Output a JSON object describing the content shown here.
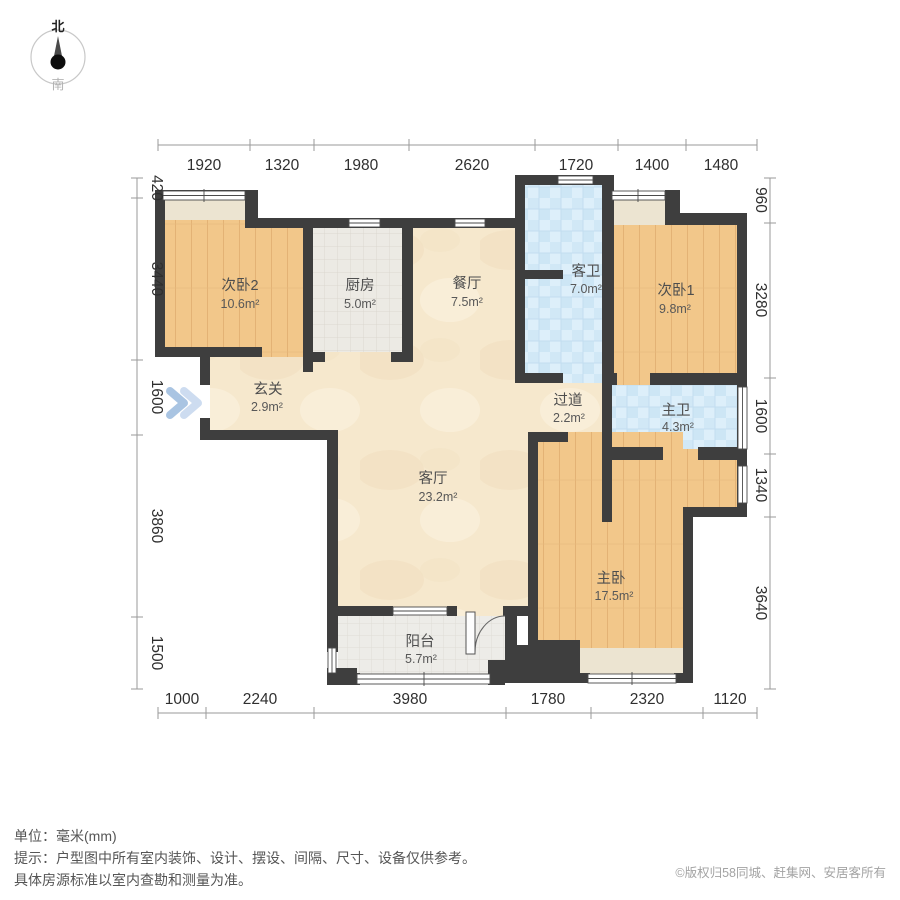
{
  "compass": {
    "north": "北",
    "south": "南"
  },
  "rooms": [
    {
      "id": "bedroom2",
      "name": "次卧2",
      "area": "10.6m²"
    },
    {
      "id": "kitchen",
      "name": "厨房",
      "area": "5.0m²"
    },
    {
      "id": "dining",
      "name": "餐厅",
      "area": "7.5m²"
    },
    {
      "id": "guest-bath",
      "name": "客卫",
      "area": "7.0m²"
    },
    {
      "id": "bedroom1",
      "name": "次卧1",
      "area": "9.8m²"
    },
    {
      "id": "entry",
      "name": "玄关",
      "area": "2.9m²"
    },
    {
      "id": "hallway",
      "name": "过道",
      "area": "2.2m²"
    },
    {
      "id": "master-bath",
      "name": "主卫",
      "area": "4.3m²"
    },
    {
      "id": "living",
      "name": "客厅",
      "area": "23.2m²"
    },
    {
      "id": "master-bedroom",
      "name": "主卧",
      "area": "17.5m²"
    },
    {
      "id": "balcony",
      "name": "阳台",
      "area": "5.7m²"
    }
  ],
  "dimensions": {
    "top": [
      "1920",
      "1320",
      "1980",
      "2620",
      "1720",
      "1400",
      "1480"
    ],
    "bottom": [
      "1000",
      "2240",
      "3980",
      "1780",
      "2320",
      "1120"
    ],
    "left": [
      "420",
      "3440",
      "1600",
      "3860",
      "1500"
    ],
    "right": [
      "960",
      "3280",
      "1600",
      "1340",
      "3640"
    ]
  },
  "footer": {
    "unit_label": "单位：毫米(mm)",
    "tip_line1": "提示：户型图中所有室内装饰、设计、摆设、间隔、尺寸、设备仅供参考。",
    "tip_line2": "具体房源标准以室内查勘和测量为准。",
    "copyright": "©版权归58同城、赶集网、安居客所有"
  },
  "colors": {
    "wall": "#3e3e3e",
    "wood_floor": "#f2c78a",
    "marble_floor": "#f6e8cd",
    "kitchen_tile": "#eceae4",
    "bath_tile": "#d9ecf8",
    "bay_strip": "#ece4d1",
    "dim_text": "#2f2f2f",
    "entry_arrow": "#aec8e6"
  }
}
